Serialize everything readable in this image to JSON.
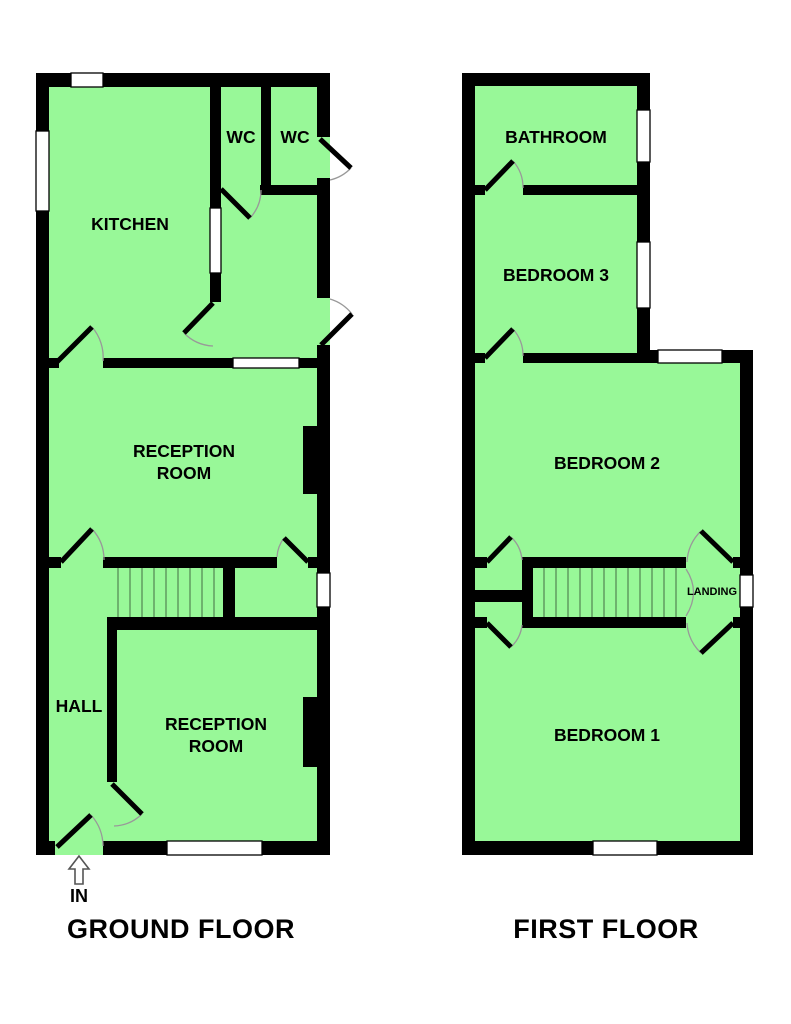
{
  "colors": {
    "room_fill": "#98f898",
    "wall": "#000000",
    "window_fill": "#ffffff",
    "stair_tread": "#4d784d",
    "door_arc": "#999999",
    "text": "#000000"
  },
  "floors": {
    "ground": {
      "title": "GROUND FLOOR",
      "entrance_label": "IN",
      "rooms": {
        "kitchen": "KITCHEN",
        "wc_left": "WC",
        "wc_right": "WC",
        "reception_mid_line1": "RECEPTION",
        "reception_mid_line2": "ROOM",
        "reception_front_line1": "RECEPTION",
        "reception_front_line2": "ROOM",
        "hall": "HALL"
      }
    },
    "first": {
      "title": "FIRST FLOOR",
      "rooms": {
        "bathroom": "BATHROOM",
        "bedroom3": "BEDROOM 3",
        "bedroom2": "BEDROOM 2",
        "bedroom1": "BEDROOM 1",
        "landing": "LANDING"
      }
    }
  }
}
